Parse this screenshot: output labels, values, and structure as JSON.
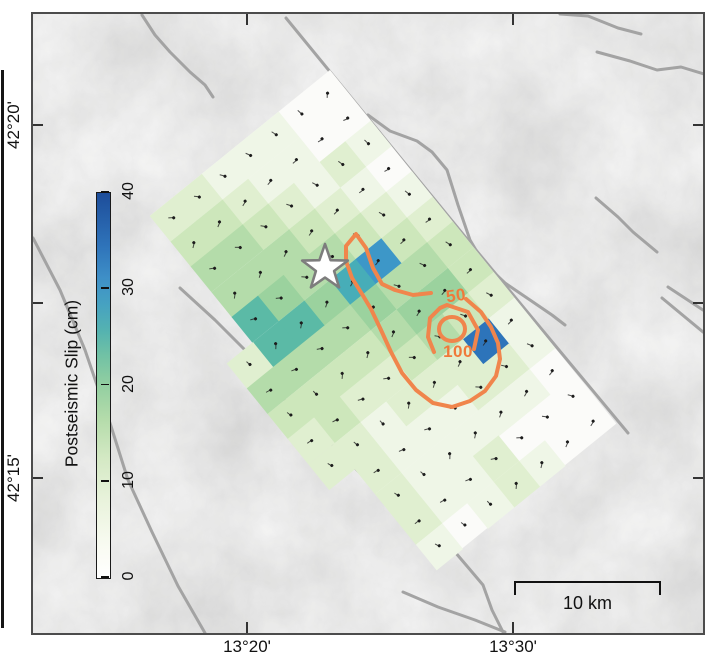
{
  "colorbar": {
    "title": "Postseismic Slip (cm)",
    "tick_labels": [
      "0",
      "10",
      "20",
      "30",
      "40"
    ],
    "min": 0,
    "max": 40
  },
  "axes": {
    "lat_labels": [
      {
        "text": "42°20'",
        "y": 125
      },
      {
        "text": "42°15'",
        "y": 478
      }
    ],
    "lon_labels": [
      {
        "text": "13°20'",
        "x": 247
      },
      {
        "text": "13°30'",
        "x": 513
      }
    ],
    "left_tick_y": [
      111,
      289,
      464
    ],
    "right_tick_y": [
      111,
      289,
      464
    ],
    "top_tick_x": [
      214,
      480
    ],
    "bottom_tick_x": [
      214,
      480
    ]
  },
  "scalebar": {
    "label": "10 km",
    "x1": 481,
    "x2": 628,
    "y": 567
  },
  "contour_labels": [
    {
      "text": "50",
      "x": 423,
      "y": 282,
      "rot": -8
    },
    {
      "text": "100",
      "x": 425,
      "y": 338,
      "rot": 0
    }
  ],
  "contour_color": "#f0854c",
  "fault_color": "#a3a3a3",
  "star": {
    "cx": 292,
    "cy": 254,
    "r_outer": 24,
    "r_inner": 9.6,
    "fill": "#ffffff",
    "stroke": "#7d7d7d"
  },
  "slip_grid": {
    "origin_note": "fault-plane slip model, 14 cols along strike x 8 rows down-dip",
    "cols": 14,
    "rows": 8,
    "cell_w": 32.5,
    "cell_h": 33,
    "rotation_deg": 51,
    "row7_visible_cols": [
      5,
      6,
      7,
      8,
      9
    ],
    "palette": [
      "#fbfbf9",
      "#eff6e7",
      "#e0efd0",
      "#cde7bb",
      "#b4dcaa",
      "#9bd29e",
      "#7cc79d",
      "#5bbaa6",
      "#47adb8",
      "#3d97c8",
      "#2d74ba"
    ],
    "matrix": [
      [
        0,
        0,
        1,
        0,
        1,
        2,
        3,
        3,
        2,
        1,
        1,
        0,
        0,
        0
      ],
      [
        0,
        0,
        2,
        1,
        2,
        3,
        4,
        5,
        3,
        10,
        2,
        1,
        0,
        0
      ],
      [
        1,
        1,
        1,
        2,
        3,
        9,
        4,
        5,
        4,
        2,
        2,
        1,
        0,
        1
      ],
      [
        1,
        1,
        2,
        3,
        4,
        8,
        5,
        4,
        3,
        2,
        1,
        1,
        2,
        2
      ],
      [
        1,
        2,
        3,
        4,
        4,
        5,
        4,
        3,
        2,
        2,
        1,
        1,
        1,
        1
      ],
      [
        2,
        3,
        4,
        4,
        5,
        7,
        4,
        3,
        2,
        1,
        1,
        1,
        1,
        0
      ],
      [
        2,
        3,
        4,
        4,
        7,
        7,
        4,
        3,
        3,
        2,
        2,
        2,
        2,
        1
      ],
      [
        0,
        0,
        0,
        0,
        0,
        2,
        4,
        3,
        2,
        2,
        0,
        0,
        0,
        0
      ]
    ]
  },
  "contours": {
    "outer_open": [
      [
        433,
        285
      ],
      [
        448,
        298
      ],
      [
        458,
        313
      ],
      [
        465,
        329
      ],
      [
        467,
        345
      ],
      [
        463,
        362
      ],
      [
        452,
        377
      ],
      [
        437,
        387
      ],
      [
        419,
        393
      ],
      [
        400,
        389
      ],
      [
        383,
        376
      ],
      [
        369,
        359
      ],
      [
        358,
        338
      ],
      [
        348,
        316
      ],
      [
        338,
        295
      ],
      [
        329,
        280
      ],
      [
        319,
        264
      ],
      [
        313,
        247
      ],
      [
        313,
        232
      ],
      [
        323,
        220
      ],
      [
        333,
        234
      ],
      [
        340,
        254
      ],
      [
        349,
        270
      ],
      [
        362,
        276
      ],
      [
        380,
        281
      ],
      [
        398,
        279
      ]
    ],
    "middle_open": [
      [
        401,
        338
      ],
      [
        395,
        323
      ],
      [
        397,
        304
      ],
      [
        407,
        294
      ],
      [
        414,
        291
      ],
      [
        435,
        298
      ],
      [
        445,
        316
      ],
      [
        441,
        335
      ]
    ],
    "inner_ellipse": {
      "cx": 419,
      "cy": 315,
      "rx": 13,
      "ry": 12
    }
  },
  "faults": [
    [
      [
        253,
        4
      ],
      [
        447,
        241
      ],
      [
        595,
        419
      ]
    ],
    [
      [
        109,
        1
      ],
      [
        122,
        21
      ],
      [
        137,
        38
      ],
      [
        157,
        58
      ],
      [
        172,
        71
      ],
      [
        180,
        83
      ]
    ],
    [
      [
        335,
        101
      ],
      [
        357,
        117
      ],
      [
        384,
        127
      ],
      [
        399,
        138
      ],
      [
        414,
        156
      ],
      [
        425,
        191
      ],
      [
        437,
        226
      ],
      [
        450,
        248
      ],
      [
        472,
        269
      ],
      [
        497,
        286
      ],
      [
        519,
        301
      ],
      [
        532,
        311
      ]
    ],
    [
      [
        0,
        224
      ],
      [
        27,
        276
      ],
      [
        52,
        336
      ],
      [
        77,
        409
      ],
      [
        95,
        466
      ],
      [
        119,
        518
      ],
      [
        145,
        572
      ],
      [
        172,
        619
      ]
    ],
    [
      [
        147,
        274
      ],
      [
        182,
        306
      ],
      [
        217,
        341
      ],
      [
        250,
        384
      ],
      [
        282,
        418
      ],
      [
        297,
        429
      ],
      [
        312,
        444
      ],
      [
        329,
        461
      ],
      [
        352,
        481
      ],
      [
        377,
        500
      ],
      [
        402,
        518
      ],
      [
        422,
        538
      ],
      [
        439,
        558
      ],
      [
        450,
        571
      ],
      [
        459,
        596
      ],
      [
        470,
        618
      ]
    ],
    [
      [
        370,
        578
      ],
      [
        405,
        593
      ],
      [
        442,
        606
      ],
      [
        472,
        618
      ]
    ],
    [
      [
        527,
        0
      ],
      [
        555,
        2
      ],
      [
        585,
        14
      ],
      [
        608,
        20
      ]
    ],
    [
      [
        564,
        38
      ],
      [
        597,
        47
      ],
      [
        624,
        56
      ],
      [
        648,
        53
      ],
      [
        671,
        60
      ]
    ],
    [
      [
        563,
        184
      ],
      [
        585,
        203
      ],
      [
        600,
        218
      ],
      [
        624,
        238
      ]
    ],
    [
      [
        635,
        273
      ],
      [
        670,
        296
      ]
    ],
    [
      [
        629,
        284
      ],
      [
        670,
        318
      ]
    ]
  ]
}
